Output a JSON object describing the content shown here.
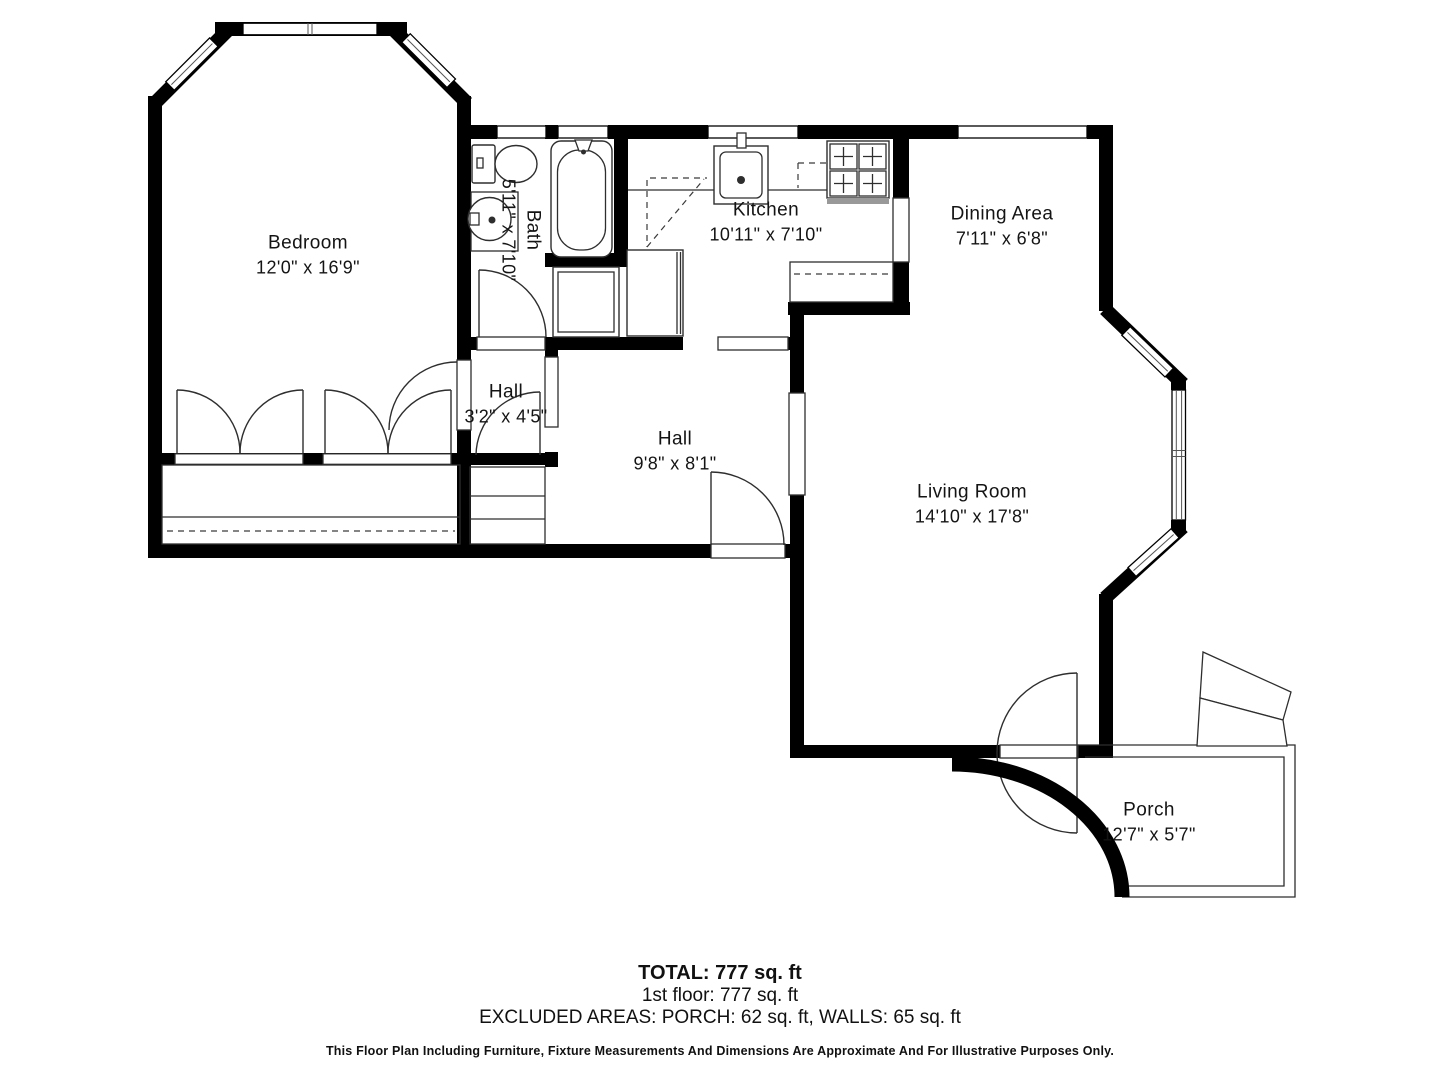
{
  "rooms": {
    "bedroom": {
      "name": "Bedroom",
      "dims": "12'0\" x 16'9\""
    },
    "bath": {
      "name": "Bath",
      "dims": "5'11\" x 7'10\""
    },
    "kitchen": {
      "name": "Kitchen",
      "dims": "10'11\" x 7'10\""
    },
    "dining": {
      "name": "Dining Area",
      "dims": "7'11\" x 6'8\""
    },
    "hall_small": {
      "name": "Hall",
      "dims": "3'2\" x 4'5\""
    },
    "hall": {
      "name": "Hall",
      "dims": "9'8\" x 8'1\""
    },
    "living": {
      "name": "Living Room",
      "dims": "14'10\" x 17'8\""
    },
    "porch": {
      "name": "Porch",
      "dims": "12'7\" x 5'7\""
    }
  },
  "summary": {
    "total": "TOTAL: 777 sq. ft",
    "floor1": "1st floor: 777 sq. ft",
    "excluded": "EXCLUDED AREAS: PORCH: 62 sq. ft, WALLS: 65 sq. ft"
  },
  "disclaimer": "This Floor Plan Including Furniture, Fixture Measurements And Dimensions Are Approximate And For Illustrative Purposes Only.",
  "colors": {
    "wall": "#000000",
    "background": "#ffffff",
    "line": "#2e2e2e",
    "text": "#141414",
    "stove_band": "#999999"
  }
}
